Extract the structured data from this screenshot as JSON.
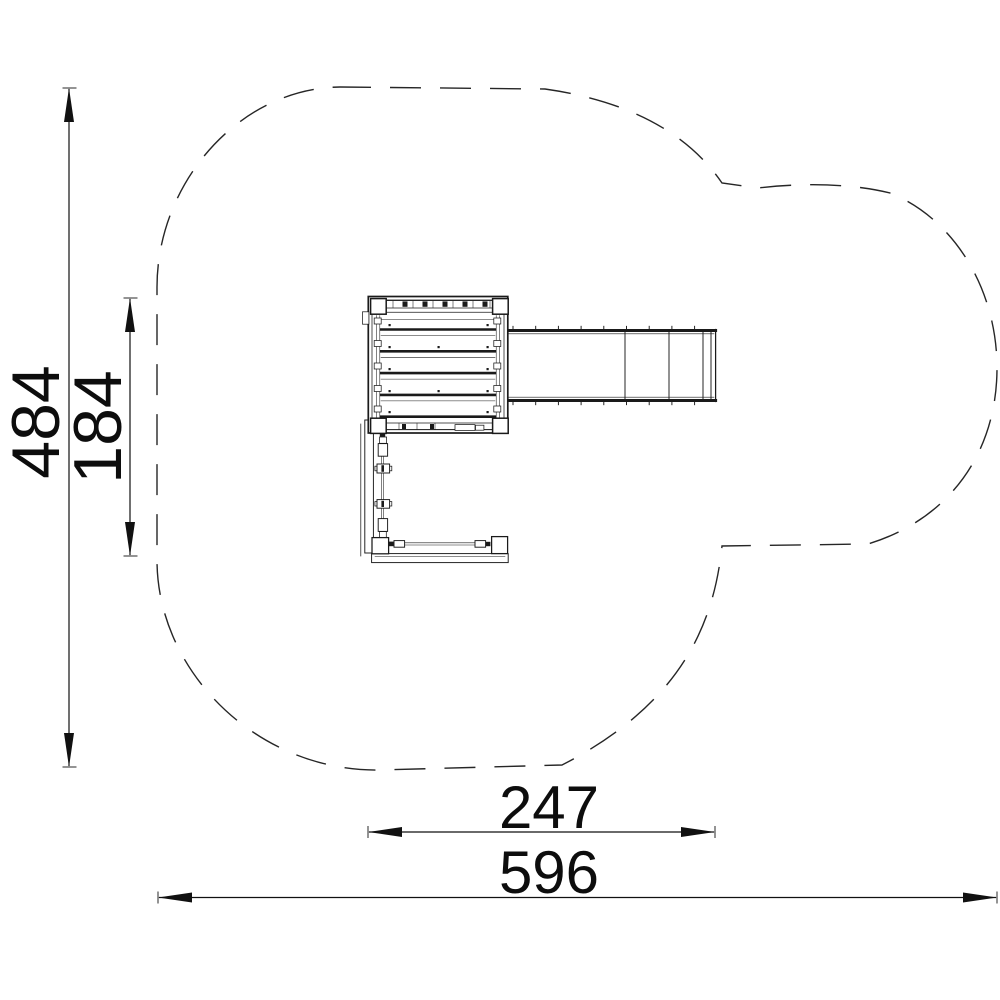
{
  "drawing": {
    "background_color": "#ffffff",
    "line_color": "#1a1a1a",
    "safety_zone_style": "dashed",
    "dimensions": {
      "overall_depth": "484",
      "equipment_depth": "184",
      "equipment_width": "247",
      "overall_width": "596"
    }
  }
}
